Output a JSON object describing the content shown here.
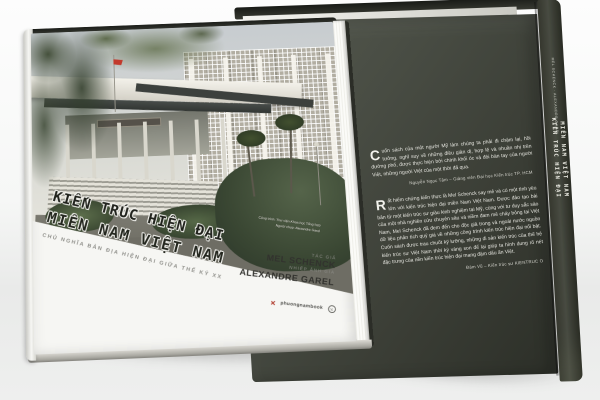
{
  "front_cover": {
    "title_line1": "KIẾN TRÚC HIỆN ĐẠI",
    "title_line2": "MIỀN NAM VIỆT NAM",
    "subtitle": "CHỦ NGHĨA BẢN ĐỊA HIỆN ĐẠI GIỮA THẾ KỶ XX",
    "author_label": "TÁC GIẢ",
    "author_name": "MEL SCHENCK",
    "photographer_label": "NHIẾP ẢNH GIA",
    "photographer_name": "ALEXANDRE GAREL",
    "publisher_logo_text": "phuongnambook",
    "photo_caption_line1": "Công trình: Thư viện Khoa học Tổng hợp",
    "photo_caption_line2": "Người chụp: Alexandre Garel"
  },
  "back_cover": {
    "quote1_dropcap": "C",
    "quote1": "uốn sách của một người Mỹ làm chúng ta phải đi chậm lại, hồi tưởng, nghĩ suy về những điều giản dị, hợp lẽ và nhuần nhị trên đường phố, được thực hiện bởi chính khối óc và đôi bàn tay của người Việt, những người Việt của một thời đã qua.",
    "quote1_attribution": "Nguyễn Ngọc Tâm – Giảng viên Đại học Kiến trúc TP. HCM",
    "quote2_dropcap": "R",
    "quote2": "ất hiếm chứng kiến thực là Mel Schenck say mê và có một tình yêu lớn với kiến trúc hiện đại miền Nam Việt Nam. Được đào tạo bài bản từ một kiến trúc sư giàu kinh nghiệm tại Mỹ, cùng với tư duy sắc sảo của một nhà nghiên cứu chuyên sâu và niềm đam mê cháy bỏng tại Việt Nam, Mel Schenck đã đem đến cho độc giả trong và ngoài nước nguồn dữ liệu phân tích quý giá về những công trình kiến trúc hiện đại nổi bật. Cuốn sách được trau chuốt kỹ lưỡng, những di sản kiến trúc của thế hệ kiến trúc sư Việt Nam thời kỳ vàng son để lại giúp ta hình dung rõ nét đặc trưng của nền kiến trúc hiện đại mang đậm dấu ấn Việt.",
    "quote2_attribution": "Đàm Vũ – Kiến trúc sư KIENTRUC O"
  },
  "spine": {
    "authors": "MEL SCHENCK · ALEXANDRE GAREL",
    "title_vertical_1": "KIẾN TRÚC HIỆN ĐẠI",
    "title_vertical_2": "MIỀN NAM VIỆT NAM"
  },
  "colors": {
    "back_cover": "#3f423a",
    "front_band": "#f6f6f3",
    "title_ink": "#20221c",
    "flag_red": "#c2392c",
    "publisher_red": "#b03a2c"
  }
}
